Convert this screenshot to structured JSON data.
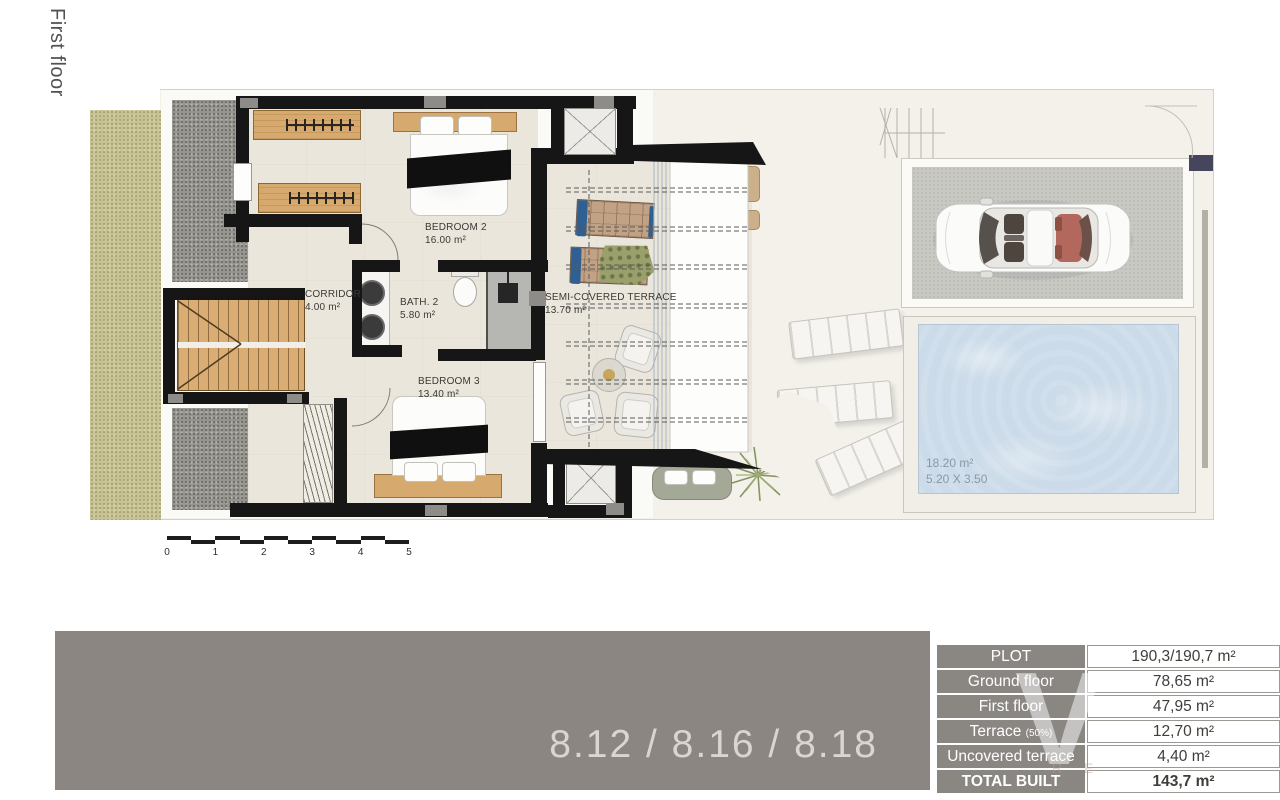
{
  "page": {
    "vertical_title": "First floor"
  },
  "plan": {
    "rooms": [
      {
        "id": "bedroom2",
        "name": "BEDROOM 2",
        "area": "16.00 m²"
      },
      {
        "id": "corridor",
        "name": "CORRIDOR",
        "area": "4.00 m²"
      },
      {
        "id": "bath2",
        "name": "BATH. 2",
        "area": "5.80 m²"
      },
      {
        "id": "bedroom3",
        "name": "BEDROOM 3",
        "area": "13.40 m²"
      },
      {
        "id": "semi_covered_terrace",
        "name": "SEMI-COVERED TERRACE",
        "area": "13.70 m²"
      }
    ],
    "pool": {
      "area": "18.20 m²",
      "dimensions": "5.20 X 3.50"
    },
    "scale_bar": {
      "ticks": [
        "0",
        "1",
        "2",
        "3",
        "4",
        "5"
      ]
    }
  },
  "banner": {
    "units": "8.12 / 8.16 / 8.18"
  },
  "summary_table": {
    "rows": [
      {
        "label": "PLOT",
        "value": "190,3/190,7 m²"
      },
      {
        "label": "Ground floor",
        "value": "78,65 m²"
      },
      {
        "label": "First floor",
        "value": "47,95 m²"
      },
      {
        "label": "Terrace",
        "label_note": "(50%)",
        "value": "12,70 m²"
      },
      {
        "label": "Uncovered terrace",
        "value": "4,40 m²"
      },
      {
        "label": "TOTAL BUILT",
        "value": "143,7 m²"
      }
    ]
  },
  "watermark": {
    "letter": "V",
    "subtext": "R E"
  },
  "colors": {
    "banner_gray": "#8b8681",
    "table_header_gray": "#8a8682",
    "pool_blue": "#cbdbe9",
    "wall_black": "#161616",
    "wood_tan": "#d6aa6e",
    "garden_olive": "#c6c294"
  }
}
